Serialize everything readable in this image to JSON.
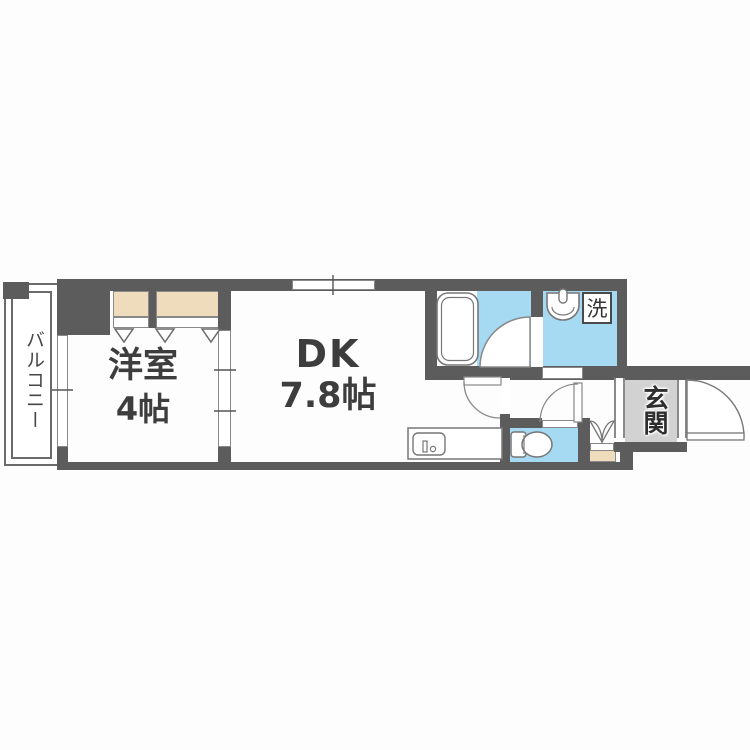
{
  "floorplan": {
    "balcony": {
      "label": "バルコニー"
    },
    "western_room": {
      "name": "洋室",
      "size": "4帖"
    },
    "dining_kitchen": {
      "name": "DK",
      "size": "7.8帖"
    },
    "entrance": {
      "label": "玄関"
    },
    "laundry": {
      "label": "洗"
    },
    "colors": {
      "wall": "#5c5c5c",
      "wet_area_floor": "#a6d9f2",
      "closet": "#efdcbd",
      "entrance_floor": "#d2d2d2",
      "fixture_outline": "#777777",
      "text": "#3d3d3d"
    }
  }
}
